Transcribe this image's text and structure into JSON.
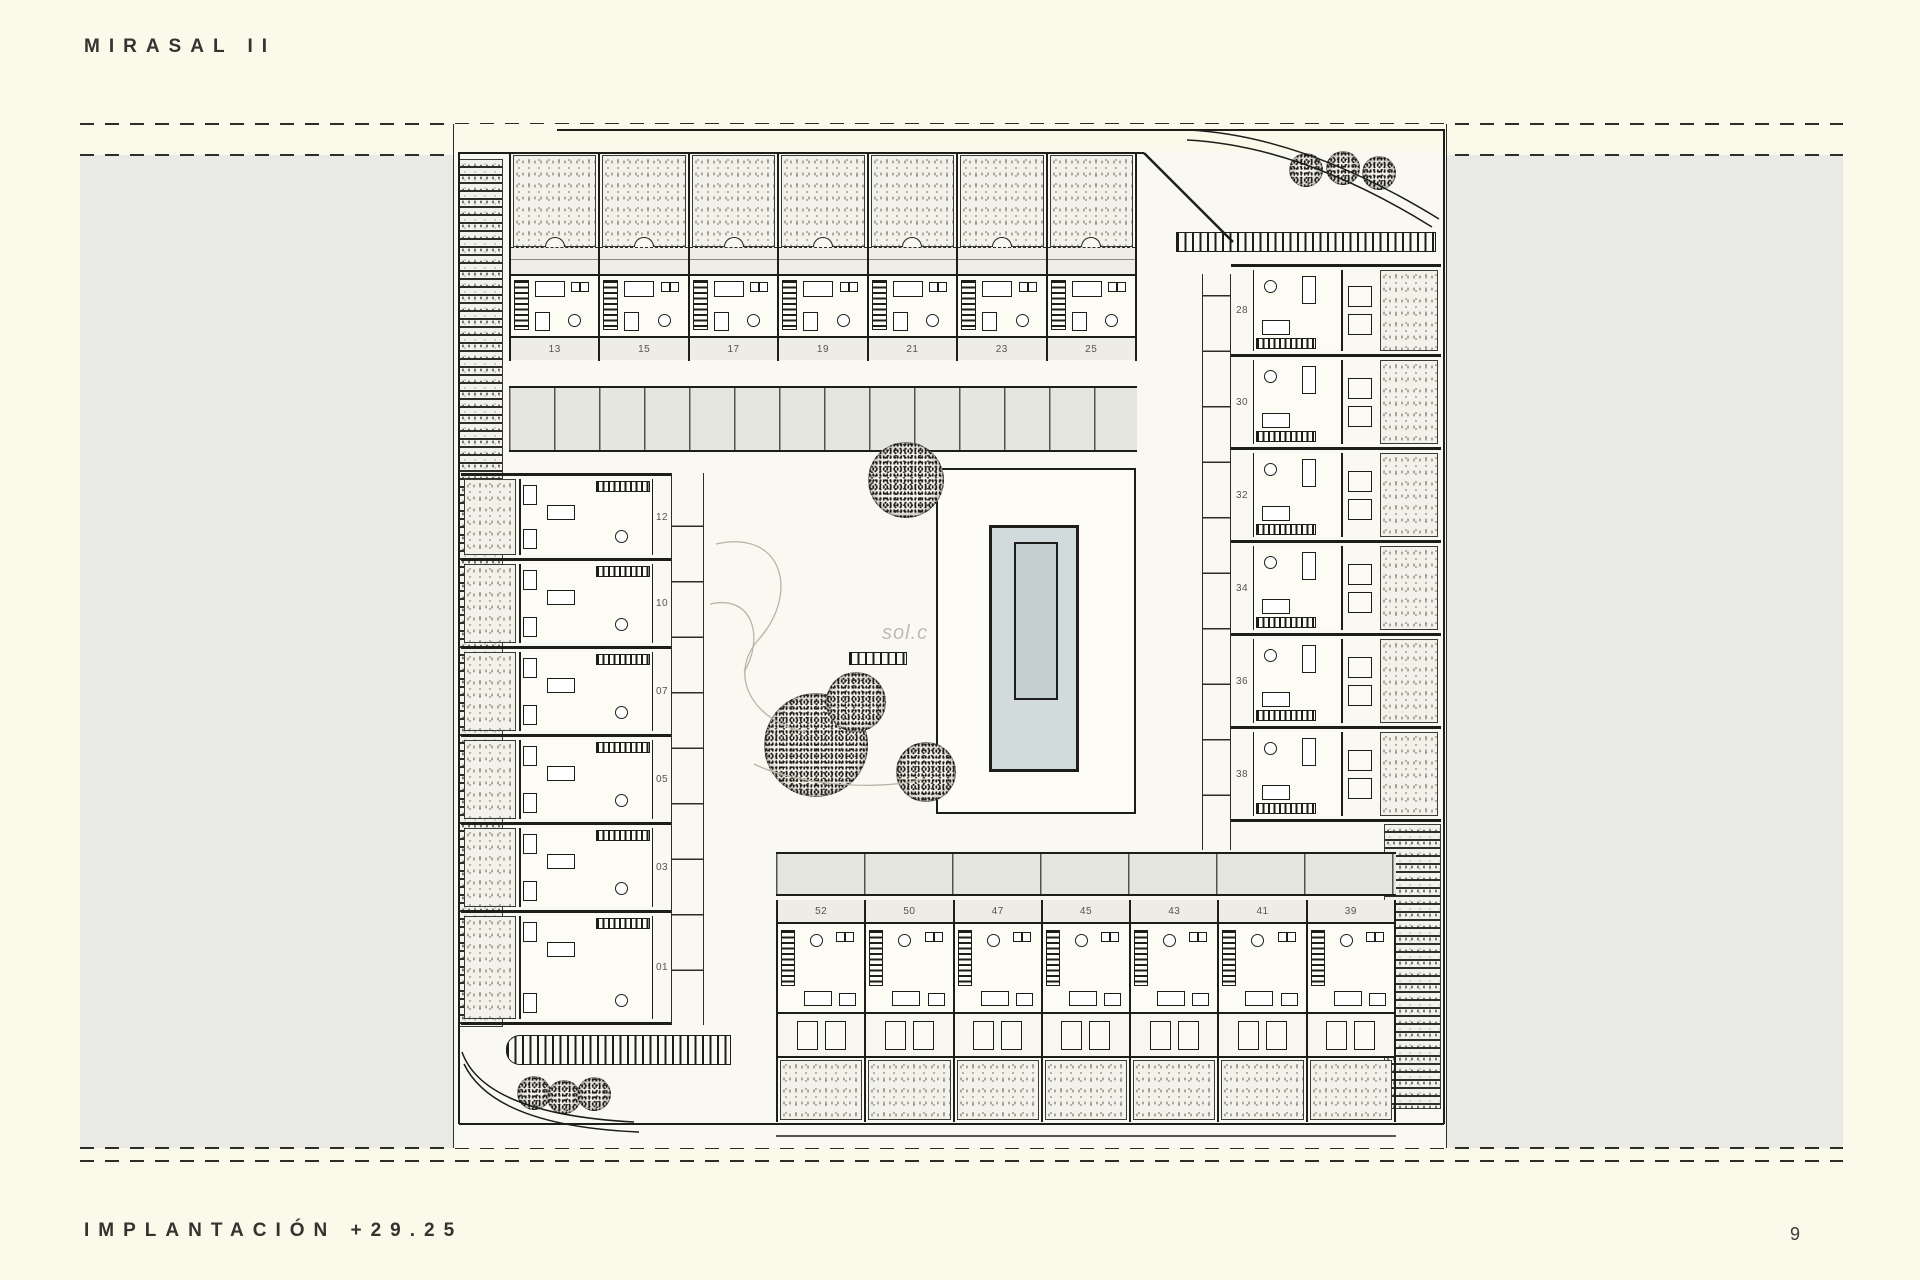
{
  "page": {
    "title": "MIRASAL II",
    "footer_label": "IMPLANTACIÓN +29.25",
    "page_number": "9",
    "watermark": "sol.c"
  },
  "colors": {
    "paper": "#FBF9EA",
    "band_gray": "#E9E9E5",
    "plan_bg": "#FAF9F1",
    "ink": "#1d1d1a",
    "stipple_bg": "#F3F2EA",
    "pool_water": "#D2DBDB",
    "pool_lane": "#C5D0D1",
    "cell_bg": "#EDECE6",
    "number_color": "#56544c"
  },
  "plan": {
    "top_row_units": [
      "13",
      "15",
      "17",
      "19",
      "21",
      "23",
      "25"
    ],
    "right_column_units": [
      "28",
      "30",
      "32",
      "34",
      "36",
      "38"
    ],
    "left_column_units": [
      "12",
      "10",
      "07",
      "05",
      "03",
      "01"
    ],
    "bottom_row_units": [
      "52",
      "50",
      "47",
      "45",
      "43",
      "41",
      "39"
    ]
  }
}
